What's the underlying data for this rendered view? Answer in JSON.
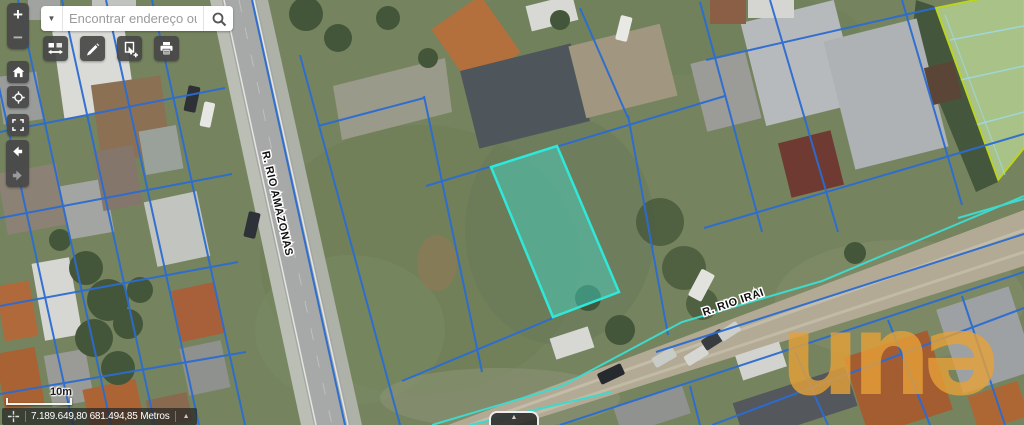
{
  "search": {
    "placeholder": "Encontrar endereço ou luga",
    "dropdown_icon": "caret-down",
    "search_icon": "magnifier"
  },
  "zoom_control": {
    "zoom_in": "+",
    "zoom_out": "−"
  },
  "toolbar": {
    "buttons": [
      {
        "name": "basemap-swipe",
        "icon": "squares-with-horizontal-arrows"
      },
      {
        "name": "draw-measure",
        "icon": "pencil"
      },
      {
        "name": "select-features",
        "icon": "cursor-select-plus"
      },
      {
        "name": "print",
        "icon": "printer"
      }
    ]
  },
  "nav_rail": {
    "buttons": [
      {
        "name": "home",
        "icon": "house"
      },
      {
        "name": "locate",
        "icon": "crosshair-circle"
      },
      {
        "name": "default-extent",
        "icon": "expand-corners"
      },
      {
        "name": "previous-extent",
        "icon": "arrow-left",
        "enabled": true
      },
      {
        "name": "next-extent",
        "icon": "arrow-right",
        "enabled": false
      }
    ]
  },
  "map": {
    "street_labels": [
      {
        "text": "R. RIO AMAZONAS"
      },
      {
        "text": "R. RIO IRAI"
      }
    ],
    "watermark": "unə",
    "colors": {
      "cadastral_line": "#2b6cd2",
      "highlight_stroke": "#2fe8da",
      "highlight_fill": "rgba(64,227,211,0.42)",
      "utility_line": "#3fd9cd",
      "field_outline": "#bcd41c",
      "watermark": "#e7a138"
    }
  },
  "status_bar": {
    "scale_label": "10m",
    "coordinates": "7.189.649,80 681.494,85 Metros",
    "capture_icon": "crosshair",
    "collapse_icon": "chevron-up"
  },
  "bottom_tab": {
    "icon": "chevron-up"
  },
  "icons": {
    "caret_down": "▼",
    "chevron_up": "▲"
  }
}
